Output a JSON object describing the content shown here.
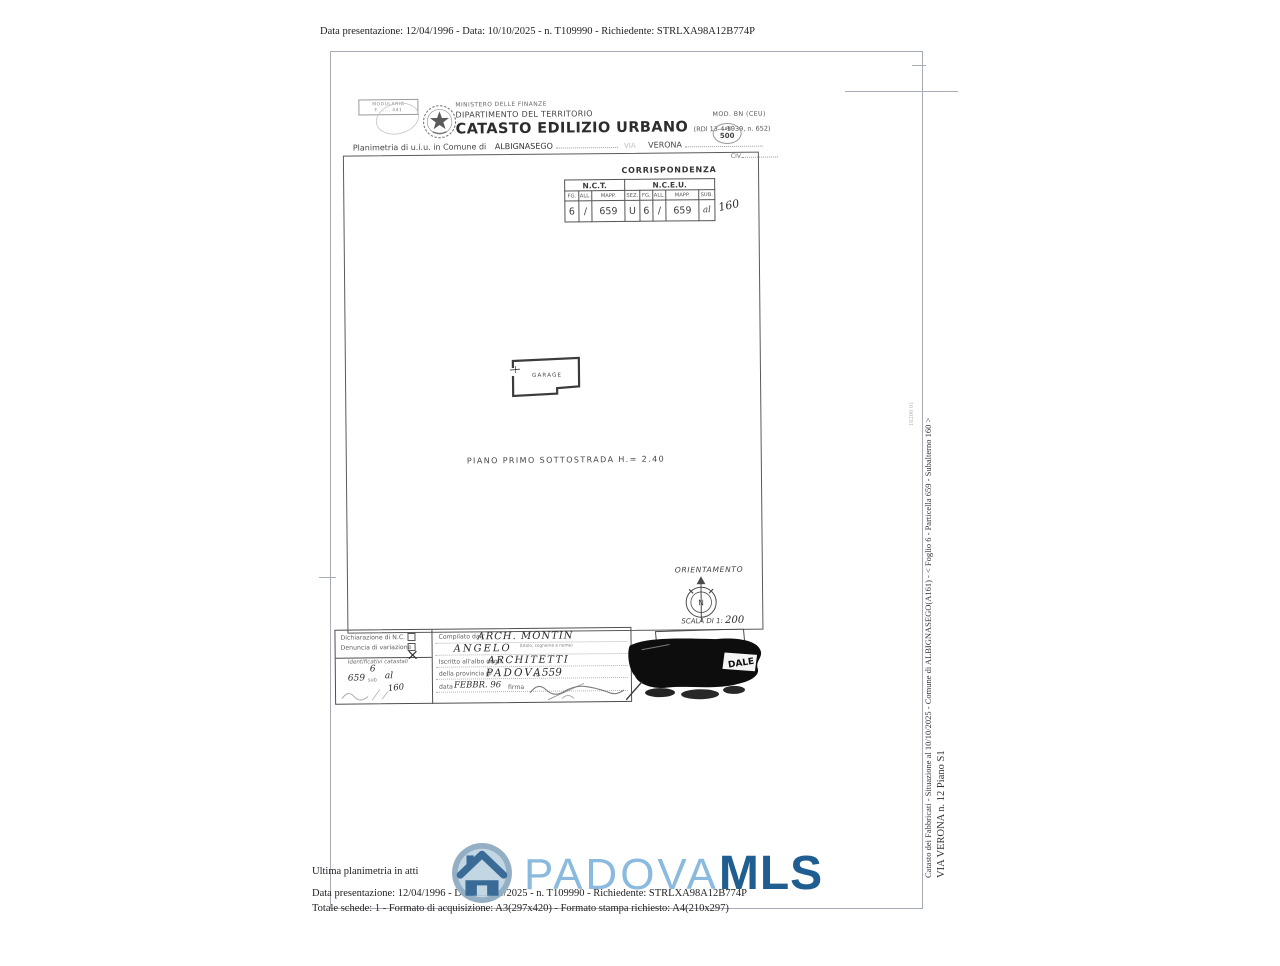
{
  "page": {
    "top_line": "Data presentazione: 12/04/1996 - Data: 10/10/2025 - n. T109990 - Richiedente: STRLXA98A12B774P"
  },
  "header": {
    "modulario_line1": "MODULARIO",
    "modulario_line2": "F. ..... 441",
    "ministero": "MINISTERO DELLE FINANZE",
    "dipartimento": "DIPARTIMENTO DEL TERRITORIO",
    "titolo": "CATASTO EDILIZIO URBANO",
    "titolo_rif": "(RDl 13-4-1939, n. 652)",
    "mod": "MOD. BN (CEU)",
    "lire": "LIRE",
    "lire_value": "500",
    "planimetria_label": "Planimetria di u.i.u. in Comune di",
    "comune": "ALBIGNASEGO",
    "via_label": "VIA",
    "via_value": "VERONA",
    "civ_label": "CIV."
  },
  "corrispondenza": {
    "title": "CORRISPONDENZA",
    "nct_label": "N.C.T.",
    "nceu_label": "N.C.E.U.",
    "headers": [
      "FG.",
      "ALL.",
      "MAPP.",
      "SEZ.",
      "FG.",
      "ALL.",
      "MAPP.",
      "SUB."
    ],
    "values": [
      "6",
      "/",
      "659",
      "U",
      "6",
      "/",
      "659",
      "al"
    ],
    "sub_handwritten": "160"
  },
  "plan": {
    "room_label": "GARAGE",
    "floor_label": "PIANO  PRIMO  SOTTOSTRADA  H.=  2.40",
    "orientation_label": "ORIENTAMENTO",
    "compass_letter": "N",
    "scale_label": "SCALA DI 1:",
    "scale_value": "200"
  },
  "form": {
    "dichiarazione_label": "Dichiarazione di N.C.",
    "denuncia_label": "Denuncia di variazione",
    "identificativi_label": "Identificativi catastali",
    "id_hand_fg": "6",
    "id_hand_mapp": "659",
    "id_sub_label": "sub",
    "id_hand_sub": "al",
    "id_hand_sub2": "160",
    "compilato_label": "Compilato dall'",
    "compilato_hand1": "ARCH.  MONTIN",
    "compilato_hand2": "ANGELO",
    "compilato_sub": "(titolo, cognome e nome)",
    "iscritto_label": "Iscritto all'albo degli",
    "albo_hand": "ARCHITETTI",
    "provincia_label": "della provincia di",
    "provincia_hand": "PADOVA",
    "n_label": "n.",
    "n_hand": "559",
    "data_label": "data",
    "data_hand": "FEBBR. 96",
    "firma_label": "firma"
  },
  "stamp": {
    "fragment": "DALE"
  },
  "sidebar": {
    "line1": "Catasto dei Fabbricati - Situazione al 10/10/2025 - Comune di ALBIGNASEGO(A161) - <  Foglio 6 - Particella  659 - Subalterno 160 >",
    "line2": "VIA VERONA n. 12 Piano S1",
    "code": "16200 01"
  },
  "footer": {
    "line1": "Ultima planimetria in atti",
    "line2": "Data presentazione: 12/04/1996 - Data: 10/10/2025 - n. T109990 - Richiedente: STRLXA98A12B774P",
    "line3": "Totale schede: 1 - Formato di acquisizione: A3(297x420) - Formato stampa richiesto: A4(210x297)"
  },
  "watermark": {
    "brand_light": "PADOVA",
    "brand_bold": "MLS",
    "light_blue": "#8abade",
    "dark_blue": "#205d90"
  }
}
